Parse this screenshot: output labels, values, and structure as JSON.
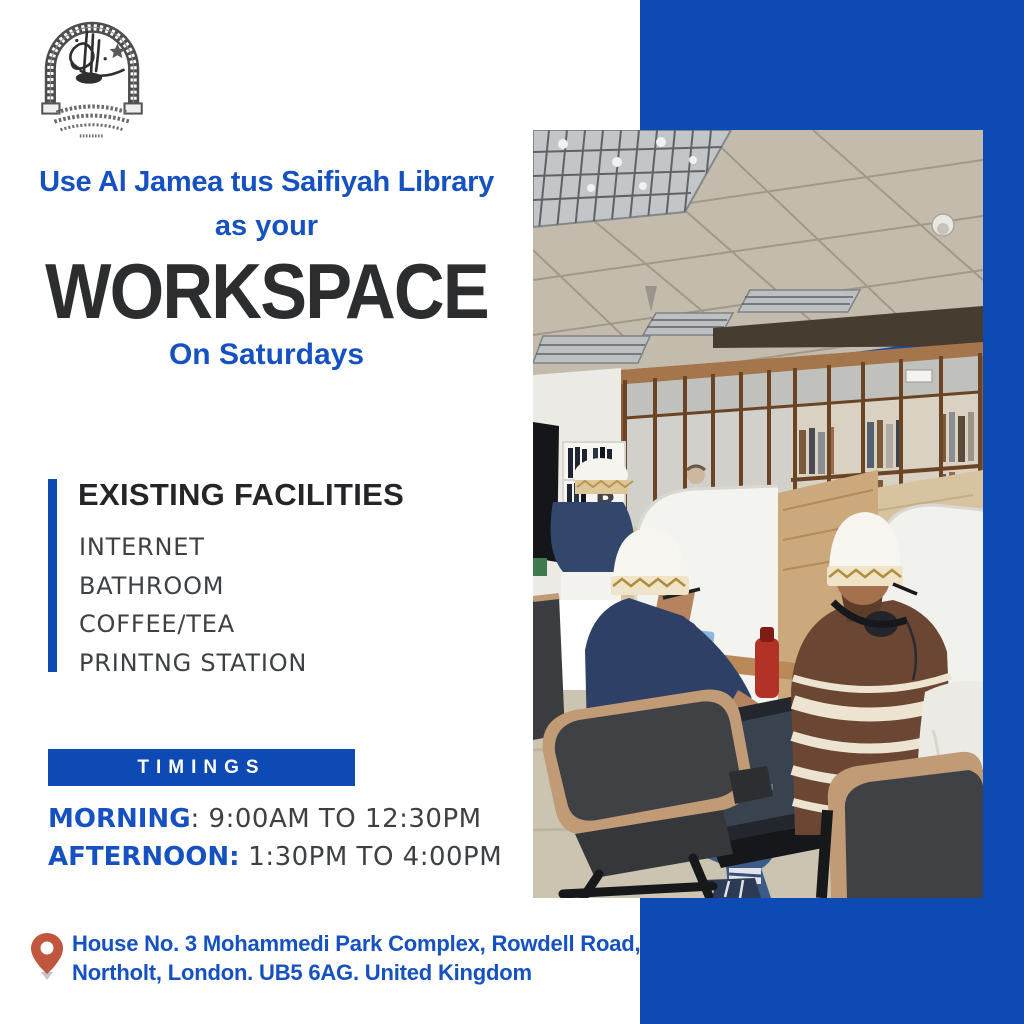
{
  "poster": {
    "logo": {
      "alt": "Al Jamea tus Saifiyah arch-and-calligraphy emblem"
    },
    "headline": {
      "line1": "Use Al Jamea tus Saifiyah Library",
      "line2": "as your",
      "emphasis": "WORKSPACE",
      "line3": "On Saturdays"
    },
    "facilities": {
      "title": "EXISTING FACILITIES",
      "items": [
        "INTERNET",
        "BATHROOM",
        "COFFEE/TEA",
        "PRINTNG STATION"
      ]
    },
    "timings": {
      "title": "TIMINGS",
      "morning_label": "MORNING",
      "morning_value": ": 9:00AM TO 12:30PM",
      "afternoon_label": "AFTERNOON:",
      "afternoon_value": " 1:30PM TO 4:00PM"
    },
    "address": {
      "line1": "House No. 3 Mohammedi Park Complex, Rowdell Road,",
      "line2": "Northolt, London. UB5 6AG. United Kingdom"
    },
    "photo": {
      "description": "Two men wearing white-and-gold topi caps working at white library study carrels, wooden glass-front bookcases behind"
    },
    "colors": {
      "accent_blue": "#0d4ab3",
      "text_blue": "#1651c2",
      "dark": "#2b2d2f",
      "list_gray": "#3e4144",
      "pin_red": "#c0563e"
    }
  }
}
